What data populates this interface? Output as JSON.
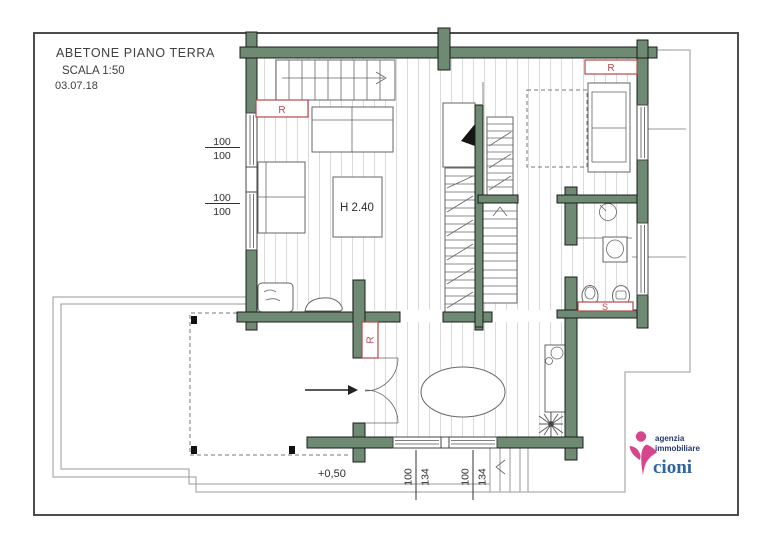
{
  "title_block": {
    "project": "ABETONE  PIANO TERRA",
    "scale": "SCALA 1:50",
    "date": "03.07.18"
  },
  "labels": {
    "room_height": "H 2.40",
    "floor_level": "+0,50",
    "radiator": "R",
    "boiler": "S"
  },
  "dimensions": {
    "left_windows": [
      {
        "w": "100",
        "h": "100"
      },
      {
        "w": "100",
        "h": "100"
      }
    ],
    "bottom_windows": [
      {
        "w": "100",
        "h": "134"
      },
      {
        "w": "100",
        "h": "134"
      }
    ]
  },
  "logo": {
    "line1": "agenzia",
    "line2": "immobiliare",
    "brand": "cioni"
  },
  "colors": {
    "wall_green": "#6e8a72",
    "radiator_red": "#b5494e",
    "logo_pink": "#d5468c",
    "logo_navy": "#233a6d",
    "logo_blue": "#31649f"
  }
}
